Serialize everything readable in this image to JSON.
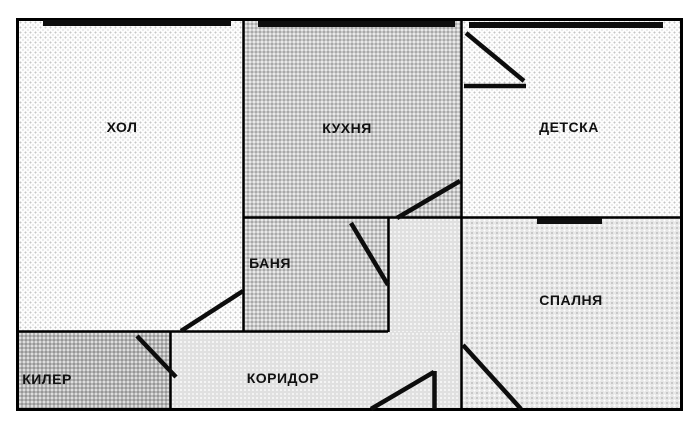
{
  "diagram": {
    "type": "apartment-floor-plan",
    "language": "Bulgarian"
  },
  "rooms": [
    {
      "id": "hol",
      "label": "ХОЛ"
    },
    {
      "id": "kuhnya",
      "label": "КУХНЯ"
    },
    {
      "id": "detska",
      "label": "ДЕТСКА"
    },
    {
      "id": "banya",
      "label": "БАНЯ"
    },
    {
      "id": "spalnya",
      "label": "СПАЛНЯ"
    },
    {
      "id": "kiler",
      "label": "КИЛЕР"
    },
    {
      "id": "koridor",
      "label": "КОРИДОР"
    }
  ],
  "features": {
    "windows_on_rooms": [
      "ХОЛ",
      "КУХНЯ",
      "ДЕТСКА",
      "СПАЛНЯ"
    ],
    "door_swings": [
      "ДЕТСКА",
      "КУХНЯ",
      "БАНЯ",
      "ХОЛ",
      "КИЛЕР",
      "СПАЛНЯ",
      "вход"
    ]
  },
  "colors": {
    "wall": "#000000",
    "background": "#ffffff",
    "room_light": "#f4f4f4",
    "room_mid": "#c9c9c9",
    "room_soft": "#e7e7e7",
    "room_corridor": "#e0e0e0",
    "room_dark": "#b5b5b5"
  }
}
